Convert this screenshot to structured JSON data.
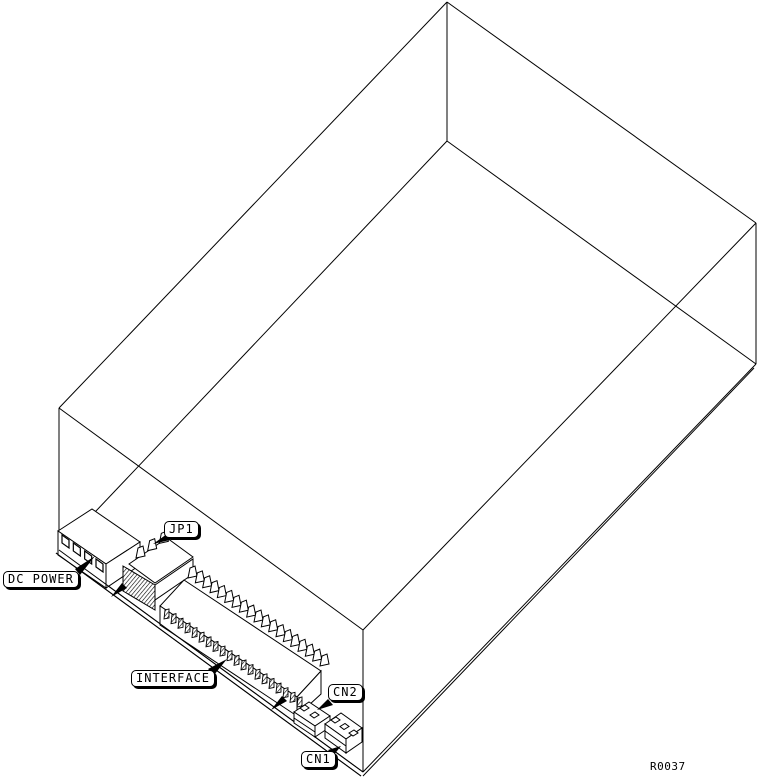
{
  "figure": {
    "background": "#ffffff",
    "line_color": "#000000",
    "kind": "isometric wireframe drawing of a disk drive with connector callouts"
  },
  "callouts": {
    "dc_power": "DC POWER",
    "jp1": "JP1",
    "interface": "INTERFACE",
    "cn2": "CN2",
    "cn1": "CN1"
  },
  "drawing_number": "R0037"
}
